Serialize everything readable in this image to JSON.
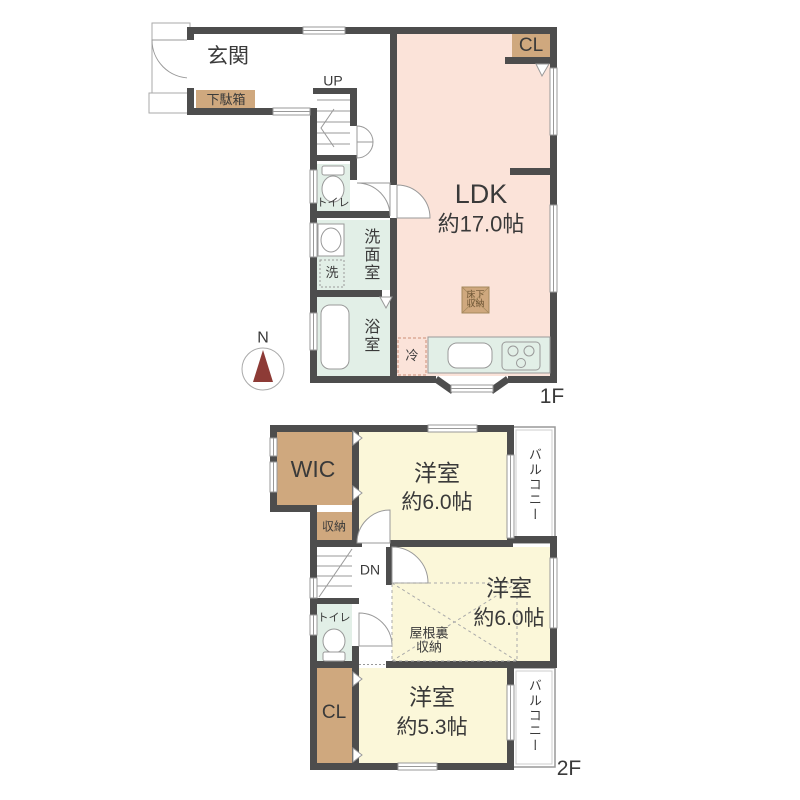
{
  "compass": {
    "label": "N"
  },
  "colors": {
    "wall": "#4d4d4d",
    "ldk_fill": "#fbe3d9",
    "wet_area_fill": "#e2efe7",
    "storage_fill": "#cfa87e",
    "bedroom_fill": "#fbf7d9",
    "north_needle": "#8d3b36"
  },
  "floor1": {
    "floor_label": "1F",
    "entrance": {
      "label": "玄関"
    },
    "shoe_cabinet": {
      "label": "下駄箱"
    },
    "stairs": {
      "label": "UP"
    },
    "toilet": {
      "label": "トイレ"
    },
    "washroom": {
      "label": "洗面室"
    },
    "washing_machine": {
      "label": "洗"
    },
    "bathroom": {
      "label": "浴室"
    },
    "ldk": {
      "label": "LDK",
      "size": "約17.0帖"
    },
    "closet": {
      "label": "CL"
    },
    "underfloor_storage": {
      "line1": "床下",
      "line2": "収納"
    },
    "refrigerator": {
      "label": "冷"
    }
  },
  "floor2": {
    "floor_label": "2F",
    "wic": {
      "label": "WIC"
    },
    "storage": {
      "label": "収納"
    },
    "stairs": {
      "label": "DN"
    },
    "toilet": {
      "label": "トイレ"
    },
    "attic_storage": {
      "line1": "屋根裏",
      "line2": "収納"
    },
    "bedroom_north": {
      "label": "洋室",
      "size": "約6.0帖"
    },
    "bedroom_middle": {
      "label": "洋室",
      "size": "約6.0帖"
    },
    "bedroom_south": {
      "label": "洋室",
      "size": "約5.3帖"
    },
    "closet": {
      "label": "CL"
    },
    "balcony_north": {
      "label": "バルコニー"
    },
    "balcony_south": {
      "label": "バルコニー"
    }
  }
}
